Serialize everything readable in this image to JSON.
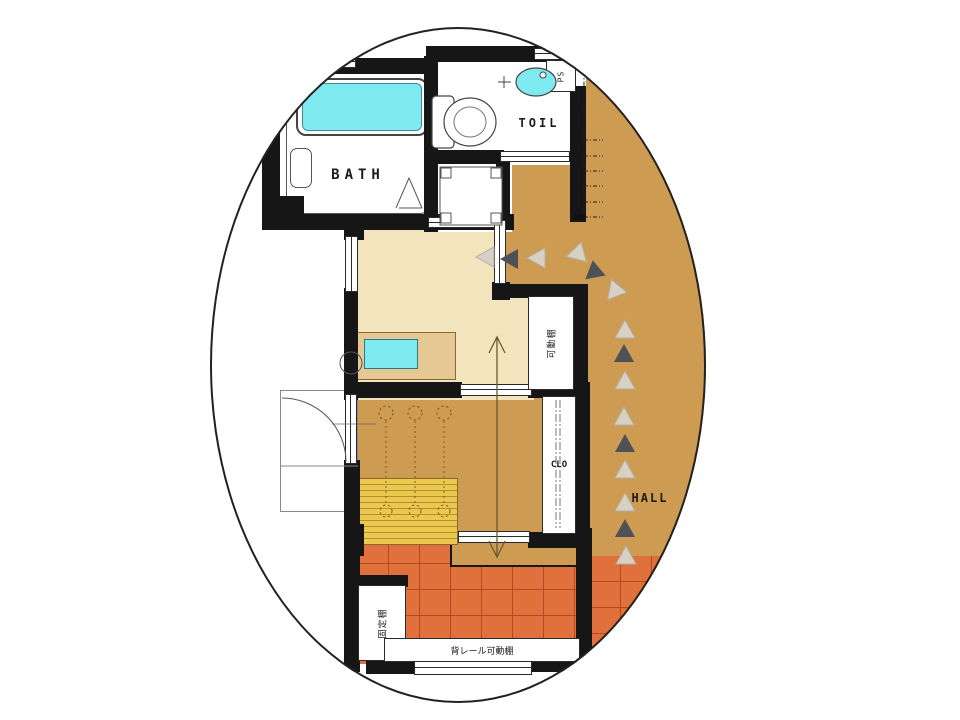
{
  "labels": {
    "bath": "BATH",
    "toilet": "TOIL",
    "pipe_space": "PS",
    "closet": "CLO",
    "hall": "HALL",
    "movable_shelf": "可動棚",
    "fixed_shelf": "固定棚",
    "rail_movable_shelf": "背レール可動棚"
  },
  "colors": {
    "wall": "#161616",
    "hall_floor": "#cd9b52",
    "room_floor": "#f2e4bd",
    "tile_floor": "#e0713c",
    "counter": "#e6c894",
    "bench": "#ecc94e",
    "bench_line": "#b18f35",
    "water": "#7fe9f0",
    "arrow_dark": "#4e5256",
    "arrow_light": "#d7d1c5"
  }
}
